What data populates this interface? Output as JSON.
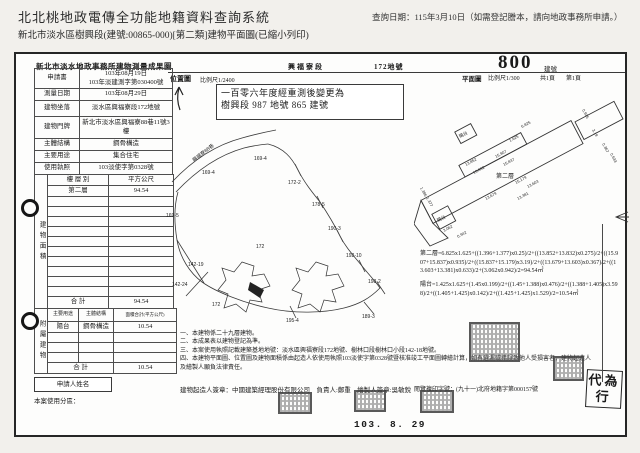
{
  "app": {
    "title": "北北桃地政電傳全功能地籍資料查詢系統",
    "query_date": "查詢日期：115年3月10日（如需登記謄本，請向地政事務所申請。）",
    "subtitle": "新北市淡水區樹興段(建號:00865-000)[第二類]建物平面圖(已縮小列印)"
  },
  "form": {
    "title": "新北市淡水地政事務所建物測量成果圖",
    "section_label": "興福寮段",
    "lot_label": "172地號",
    "building_no_hand": "800",
    "building_no_suffix": "建號",
    "info_rows": [
      {
        "label": "申請書",
        "value": "103年08月19日",
        "value2": "103年淡建測字第030400號"
      },
      {
        "label": "測量日期",
        "value": "103年08月29日"
      },
      {
        "label": "建物坐落",
        "value": "淡水區興福寮段172地號"
      },
      {
        "label": "建物門牌",
        "value": "新北市淡水區興福寮88巷11號3樓"
      },
      {
        "label": "主體結構",
        "value": "鋼骨構造"
      },
      {
        "label": "主要用途",
        "value": "集合住宅"
      },
      {
        "label": "使用執照",
        "value": "103淡使字第0328號"
      }
    ],
    "area_table": {
      "side_label": "建物面積",
      "col1": "樓 層 別",
      "col2": "平方公尺",
      "floor": "第二層",
      "floor_area": "94.54",
      "total_label": "合  計",
      "total": "94.54"
    },
    "annex_table": {
      "side_label": "附屬建物",
      "h1": "主要用途",
      "h2": "主體結構",
      "h3": "面積合計(平方公尺)",
      "use": "陽台",
      "structure": "鋼骨構造",
      "area": "10.54",
      "total_label": "合  計",
      "total": "10.54"
    },
    "applicant_label": "申請人姓名",
    "zoning_label": "本案使用分區："
  },
  "location_map": {
    "label": "位置圖",
    "scale": "比例尺1/2400",
    "remeasure_line1": "一百零六年度經重測後變更為",
    "remeasure_line2": "樹興段 987 地號 865 建號",
    "road_label": "興福寮88巷",
    "lots": [
      "169-4",
      "169-4",
      "172-2",
      "178-5",
      "190-3",
      "169-5",
      "172",
      "142-19",
      "142-24",
      "192-10",
      "198-2",
      "172",
      "195-4",
      "189-3"
    ]
  },
  "floor_plan": {
    "label": "平面圖",
    "scale": "比例尺1/300",
    "pages": "共1頁",
    "page": "第1頁",
    "room_label": "第二層",
    "balcony_label": "陽台",
    "dimensions": [
      "6.825",
      "1.625",
      "13.852",
      "13.832",
      "15.907",
      "15.837",
      "15.179",
      "3.19",
      "0.935",
      "0.367",
      "13.679",
      "13.603",
      "13.381",
      "0.633",
      "3.062",
      "0.942",
      "1.396",
      "1.377"
    ]
  },
  "calculations": {
    "second_floor": "第二層=6.825x1.625+((1.396+1.377)x0.25)/2+((13.852+13.832)x0.275)/2+((15.907+15.837)x0.935)/2+((15.837+15.179)x3.19)/2+((13.679+13.603)x0.367)/2+((13.603+13.381)x0.633)/2+(3.062x0.942)/2=94.54㎡",
    "balcony": "陽台=1.425x1.625+(1.45x0.199)/2+((1.45+1.388)x0.476)/2+((1.388+1.405)x3.598)/2+((1.405+1.425)x0.142)/2+((1.425+1.425)x1.529)/2=10.54㎡"
  },
  "notes": [
    "一、本建物係二十九層建物。",
    "二、本成果表以建物登記為準。",
    "三、本案使用執照記載建築基地地號：淡水區興福寮段172地號、樹林口段樹林口小段142-18地號。",
    "四、本建物平面圖、位置圖及建物面積係由起造人依使用執照103淡使字第0328號暨核准竣工平面圖轉繪計算，如有遺漏或錯誤致他人受損害者，建物起造人及繪製人願負法律責任。"
  ],
  "footer": {
    "builder_line": "建物起造人簽章：中國建築經理股份有限公司　負責人:鄭重　繪製人簽章:吳敏銳",
    "copy_no": "閱覽複印字號：(九十一)北府地籍字第000157號",
    "date_stamp": "103. 8. 29",
    "proxy_stamp": "代為行"
  }
}
